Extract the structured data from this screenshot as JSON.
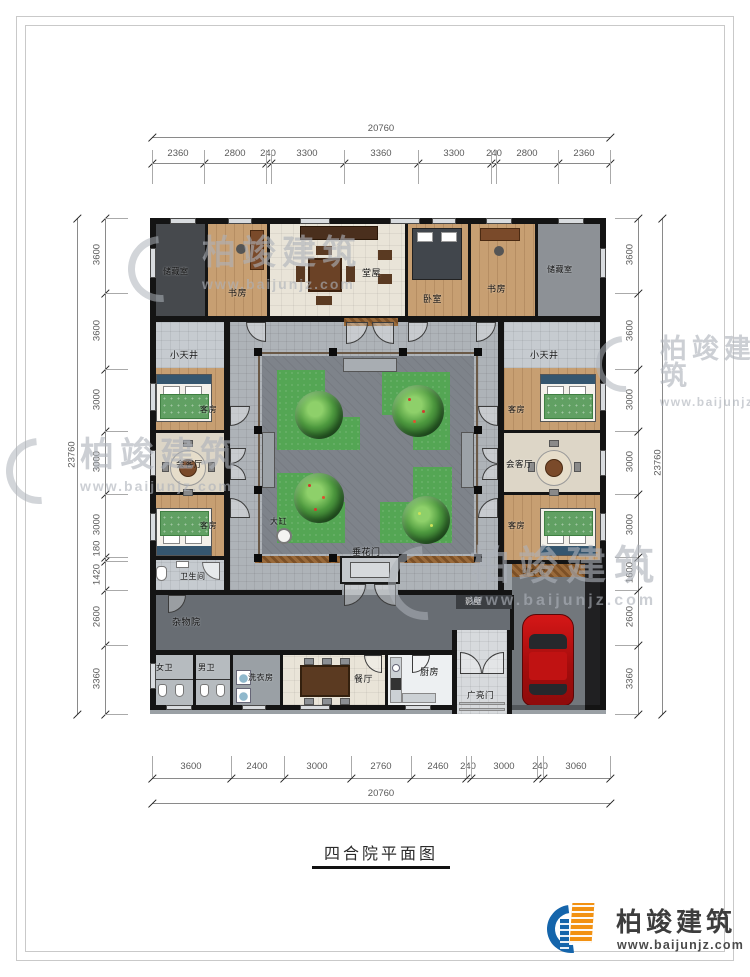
{
  "title": "四合院平面图",
  "logo": {
    "brand": "柏竣建筑",
    "site": "www.baijunjz.com"
  },
  "watermark": {
    "brand": "柏竣建筑",
    "site": "www.baijunjz.com"
  },
  "dims": {
    "top": {
      "total": "20760",
      "segments": [
        "2360",
        "2800",
        "240",
        "3300",
        "3360",
        "3300",
        "240",
        "2800",
        "2360"
      ]
    },
    "bottom": {
      "total": "20760",
      "segments": [
        "3600",
        "2400",
        "3000",
        "2760",
        "2460",
        "240",
        "3000",
        "240",
        "3060"
      ]
    },
    "left": {
      "total": "23760",
      "segments": [
        "3600",
        "3600",
        "3000",
        "3000",
        "3000",
        "180",
        "1420",
        "2600",
        "3360"
      ]
    },
    "right": {
      "total": "23760",
      "segments": [
        "3600",
        "3600",
        "3000",
        "3000",
        "3000",
        "1600",
        "2600",
        "3360"
      ]
    }
  },
  "rooms": {
    "storage_left": "储藏室",
    "study_left": "书房",
    "main_hall": "堂屋",
    "bedroom": "卧室",
    "study_right": "书房",
    "storage_right": "储藏室",
    "lightwell_left": "小天井",
    "lightwell_right": "小天井",
    "guest_left_top": "客房",
    "parlor_left": "会客厅",
    "guest_left_bottom": "客房",
    "guest_right_top": "客房",
    "parlor_right": "会客厅",
    "guest_right_bottom": "客房",
    "festoon_gate": "垂花门",
    "water_vat": "大缸",
    "bathroom": "卫生间",
    "utility_yard": "杂物院",
    "women_wc": "女卫",
    "men_wc": "男卫",
    "laundry": "洗衣房",
    "dining": "餐厅",
    "kitchen": "厨房",
    "main_gate": "广亮门",
    "screen_wall": "影壁",
    "parking": "停车位"
  },
  "colors": {
    "wall": "#141414",
    "wood_floor": "#c79f72",
    "walkway": "#aeb3b8",
    "courtyard": "#7e838a",
    "lawn": "#54a654",
    "brand_blue": "#1565ab",
    "brand_orange": "#f29111",
    "car_red": "#c11212"
  }
}
